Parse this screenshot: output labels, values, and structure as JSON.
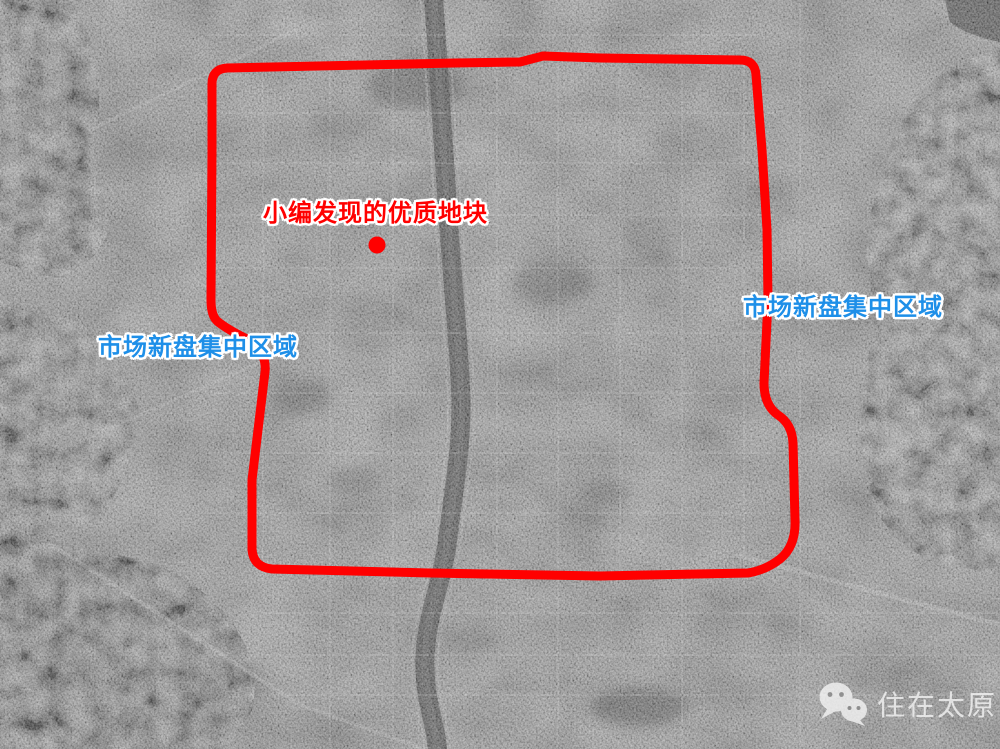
{
  "map": {
    "annotations": {
      "site_label": "小编发现的优质地块",
      "left_region_label": "市场新盘集中区域",
      "right_region_label": "市场新盘集中区域"
    },
    "marker": {
      "shape": "dot",
      "color": "#ff0000"
    },
    "boundary": {
      "color": "#ff0000"
    },
    "colors": {
      "annotation_red": "#ff0000",
      "annotation_blue": "#1e8fe8",
      "outline_white": "#ffffff"
    }
  },
  "watermark": {
    "icon": "wechat-icon",
    "text": "住在太原"
  }
}
